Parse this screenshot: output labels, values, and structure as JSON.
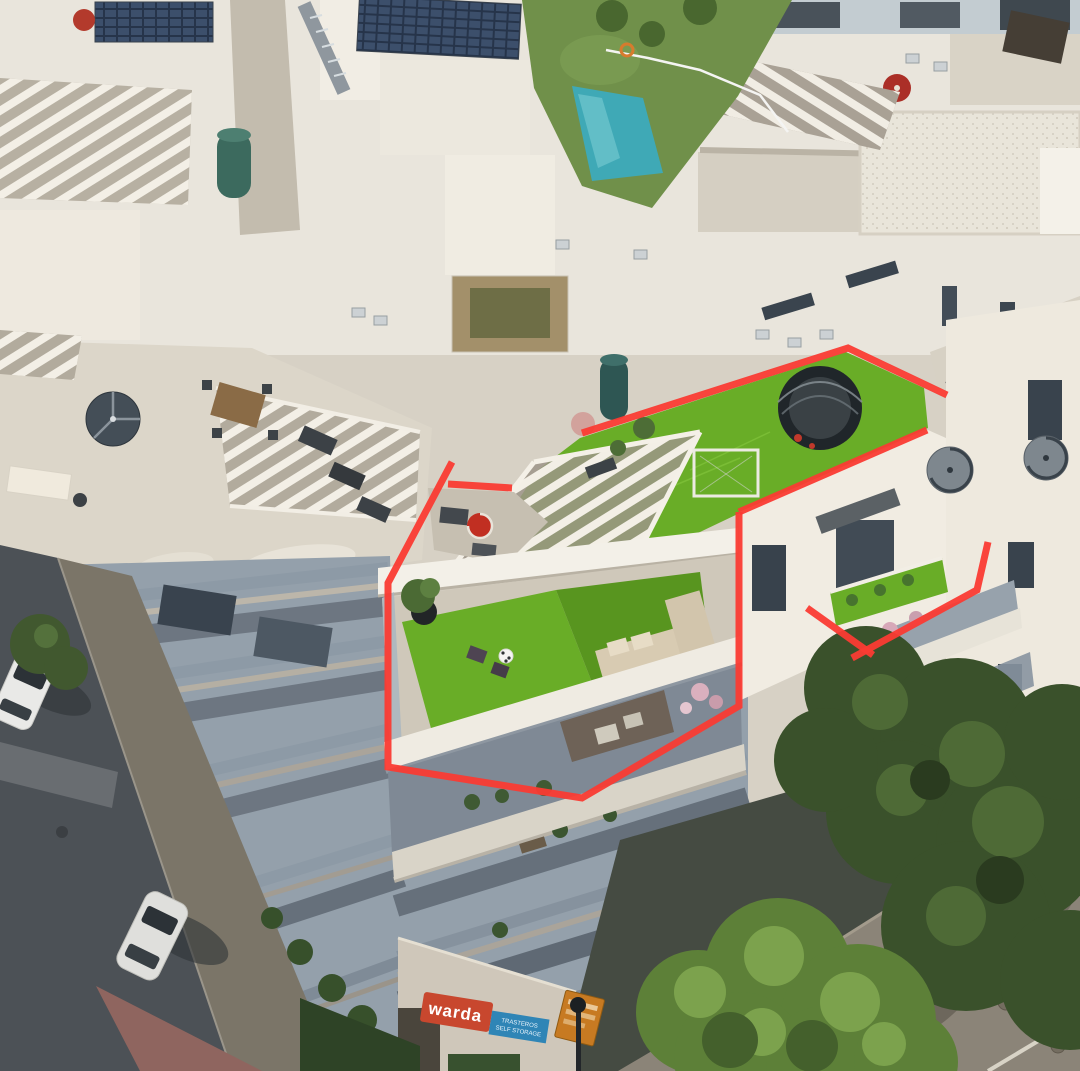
{
  "scene": {
    "type": "aerial drone photograph",
    "subject": "white Mediterranean apartment complex, duplex corner penthouse with artificial-turf roof terraces outlined in red"
  },
  "palette": {
    "annotation-red": "#fa3b33",
    "turf-green": "#69ad27",
    "lawn-green": "#70904a",
    "pool-blue": "#3fa9b6",
    "tree-dark": "#3a512b",
    "tree-bright": "#5d8038",
    "asphalt-shadow": "#4c5156",
    "sidewalk-shadow": "#7b7568",
    "facade-shadow": "#94a0ab",
    "warda-red": "#c8472e",
    "warda-blue": "#2f85b6",
    "orange-sign": "#c77a22"
  },
  "annotation": {
    "stroke_width": 7,
    "outline_segments": [
      "448,484 512,488",
      "452,462 388,583 388,767 582,798 739,706 739,512",
      "739,512 927,430",
      "582,433 848,348 947,395"
    ],
    "marker_segments": [
      "988,542 977,590 852,658",
      "807,608 873,655"
    ]
  },
  "signs": {
    "warda": {
      "brand": "warda",
      "tagline_line1": "TRASTEROS",
      "tagline_line2": "SELF STORAGE"
    }
  }
}
